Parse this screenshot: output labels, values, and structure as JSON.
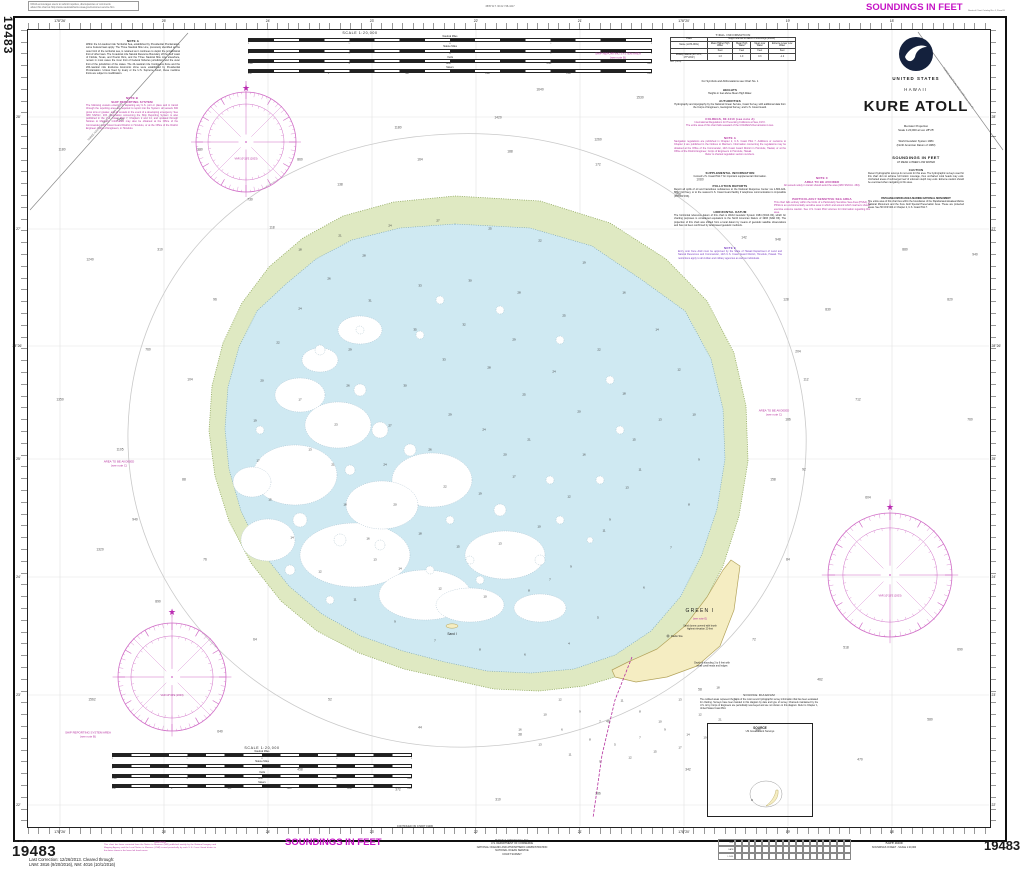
{
  "page": {
    "chart_number": "19483",
    "top_left_note": "NOAA encourages users to submit inquiries, discrepancies or comments\nabout this chart at http://www.nauticalcharts.noaa.gov/customer-service.htm",
    "print_code": "3835 W.T. 30.02  748-4417",
    "soundings_top": "SOUNDINGS IN FEET",
    "catalog_note": "Nautical Chart Catalog No. 4, Panel B",
    "edition": "9th Ed., Jan. 2003",
    "last_correction": "Last Correction: 12/26/2013. Cleared through:\nLNM: 3816 (9/20/2016), NM: 4016 (10/1/2016)",
    "caution_title": "CAUTION",
    "caution_body": "This chart has been corrected from the Notice to Mariners (NM) published weekly by the National Imagery and Mapping Agency and the Local Notice to Mariners (LNM) issued periodically by each U.S. Coast Guard district to the dates shown in the lower left hand corner.",
    "soundings_bottom": "SOUNDINGS IN FEET",
    "continued_note": "CONTINUED ON CHART 19480",
    "publisher": "Published at Washington, D.C.\nU.S. DEPARTMENT OF COMMERCE\nNATIONAL OCEANIC AND ATMOSPHERIC ADMINISTRATION\nNATIONAL OCEAN SERVICE\nCOAST SURVEY",
    "footer_title": "Kure Atoll",
    "footer_subtitle": "SOUNDINGS IN FEET - SCALE 1:20,000",
    "correction_rows": [
      "N.M.",
      "DATE",
      "L.N.M."
    ]
  },
  "title_block": {
    "country": "UNITED STATES",
    "state": "HAWAII",
    "title": "KURE ATOLL",
    "projection": "Mercator Projection\nScale 1:20,000 at Lat. 28°25'",
    "datum": "World Geodetic System 1984\n(North American Datum of 1983)",
    "soundings": "SOUNDINGS IN FEET",
    "soundings_sub": "AT MEAN LOWER LOW WATER",
    "caution": {
      "title": "CAUTION",
      "body": "Recent hydrographic surveys do not exist for this area. The hydrographic surveys used for this chart did not achieve full bottom coverage, thus uncharted coral heads may exist. Uncharted areas of submerged reef of unknown depth may exist. Extreme caution should be exercised when navigating in this area."
    },
    "monument": {
      "title": "PAPAHANAUMOKUAKEA MARINE NATIONAL MONUMENT",
      "body": "The entire area of this chart lies within the boundaries of the Papahanaumokuakea Marine National Monument and the Kure Atoll Special Preservation Area. These are protected areas. See 50 CFR 404 or Chapter 2, U.S. Coast Pilot 7."
    }
  },
  "notes": {
    "note_a": {
      "title": "NOTE A",
      "body": "Within the 12-nautical mile Territorial Sea, established by Presidential Proclamation, some Federal laws apply. The Three Nautical Mile Line, previously identified as the outer limit of the territorial sea, is retained as it continues to depict the jurisdictional limit of other laws. The 9-nautical mile Natural Resource Boundary off the Gulf coast of Florida, Texas, and Puerto Rico, and the Three Nautical Mile Line elsewhere, remain in most cases the inner limit of Federal fisheries jurisdiction and the outer limit of the jurisdiction of the states. The 24-nautical mile Contiguous Zone and the 200-nautical mile Exclusive Economic Zone were established by Presidential Proclamation. Unless fixed by treaty or the U.S. Supreme Court, these maritime limits are subject to modification."
    },
    "note_b": {
      "title": "NOTE B",
      "subtitle": "SHIP REPORTING SYSTEM",
      "body": "The following vessels entering or departing any U.S. port or place and in transit through the reporting area are required to report into the System: all vessels 300 gross tons or greater, and all vessels in the event of a developing emergency. See IMO SN/Circ. 215. Information concerning the Ship Reporting System is also published in the U.S. Coast Pilot 7, Chapters 2 and 14, and updated through Notices to Mariners. Information may also be obtained at the Office of the Commander, 14th Coast Guard District in Honolulu, or at the Office of the District Engineer, Corps of Engineers, in Honolulu."
    },
    "symbols": "For Symbols and Abbreviations see Chart No. 1",
    "heights": {
      "title": "HEIGHTS",
      "body": "Heights in feet above Mean High Water."
    },
    "authorities": {
      "title": "AUTHORITIES",
      "body": "Hydrography and topography by the National Ocean Service, Coast Survey, with additional data from the Corps of Engineers, Geological Survey, and U.S. Coast Guard."
    },
    "colregs": {
      "title": "COLREGS, 80.1410 (see note A)",
      "body": "International Regulations for Preventing Collisions at Sea, 1972.\nThe entire area of this chart falls seaward of the COLREGS Demarcation Lines."
    },
    "nav_regs": {
      "title": "NOTE A",
      "body": "Navigation regulations are published in Chapter 2, U.S. Coast Pilot 7. Additions or revisions to Chapter 2 are published in the Notices to Mariners. Information concerning the regulations may be obtained at the Office of the Commander, 14th Coast Guard District in Honolulu, Hawaii, or at the Office of the District Engineer, Corps of Engineers in Honolulu, Hawaii.",
      "tail": "Refer to charted regulation section numbers."
    },
    "supplemental": {
      "title": "SUPPLEMENTAL INFORMATION",
      "body": "Consult U.S. Coast Pilot 7 for important supplemental information."
    },
    "pollution": {
      "title": "POLLUTION REPORTS",
      "body": "Report all spills of oil and hazardous substances to the National Response Center via 1-800-424-8802 (toll free), or to the nearest U.S. Coast Guard facility if telephone communication is impossible (33 CFR 153)."
    },
    "datum": {
      "title": "HORIZONTAL DATUM",
      "body": "The horizontal reference datum of this chart is World Geodetic System 1984 (WGS 84), which for charting purposes is considered equivalent to the North American Datum of 1983 (NAD 83). The projection of this chart was shifted from a local datum by means of geodetic satellite observations and has not been confirmed by land-based geodetic methods."
    },
    "note_e": {
      "title": "NOTE E",
      "body": "Entry onto Kure Atoll must be approved by the State of Hawaii Department of Land and Natural Resources and Commander, 14th U.S. Coast Guard District, Honolulu, Hawaii. The restrictions apply to all civilian and military agencies as well as individuals."
    },
    "note_c": {
      "title": "NOTE C",
      "subtitle": "AREA TO BE AVOIDED",
      "body": "All vessels solely in transit should avoid the area (IMO SN/Circ. 263)."
    },
    "pssa": {
      "title": "PARTICULARLY SENSITIVE SEA AREA",
      "body": "This chart falls entirely within the limits of a Particularly Sensitive Sea Area (PSSA). A PSSA is an environmentally sensitive area in which and around which mariners should exercise extreme caution. See U.S. Coast Pilot volumes for information regarding this area."
    }
  },
  "tidal": {
    "title": "TIDAL INFORMATION",
    "place_header": "Place",
    "heights_header": "Height referred to datum of soundings (MLLW)",
    "name_label": "Name",
    "latlong_label": "(LAT/LONG)",
    "columns": [
      "Mean Higher High Water",
      "Mean High Water",
      "Mean Low Water",
      "Extreme Lower Low Water"
    ],
    "units": "Feet",
    "station": "Midway Islands (28°13'N., 177°22'W.)",
    "values": [
      "1.3",
      "1.0",
      "0.3",
      "-1.2"
    ],
    "note": "Nov. (2003)"
  },
  "scale": {
    "title": "SCALE 1:20,000",
    "rows": [
      {
        "label": "Nautical Miles",
        "ticks": [
          "1",
          "½",
          "0",
          "½",
          "1"
        ]
      },
      {
        "label": "Statute Miles",
        "ticks": [
          "1",
          "½",
          "0",
          "½",
          "1"
        ]
      },
      {
        "label": "Yards",
        "ticks": [
          "1000",
          "0",
          "1000",
          "2000",
          "3000"
        ]
      },
      {
        "label": "Meters",
        "ticks": [
          "500",
          "0",
          "500",
          "1000",
          "1500",
          "2000"
        ]
      }
    ]
  },
  "source": {
    "title": "SOURCE DIAGRAM",
    "body": "The outlined areas represent the limits of the most recent hydrographic survey information that has been evaluated for charting. Surveys have been banded in this diagram by date and type of survey. Channels maintained by the U.S. Army Corps of Engineers are periodically resurveyed and are not shown on this diagram. Refer to Chapter 1, United States Coast Pilot.",
    "box_title": "SOURCE",
    "box_subtitle": "US Government Surveys"
  },
  "map": {
    "labels": {
      "srs": "SHIP REPORTING SYSTEM AREA\n(see note B)",
      "avoid": "AREA TO BE AVOIDED\n(see note C)",
      "green_island": "GREEN I",
      "green_note": "(see note E)",
      "dunes": "Sand dunes covered with brush\nhighest elevation 20 feet",
      "radio": "Radio Sta",
      "depth_note": "Depth of sounding 3 to 6 feet with\nsmall coral heads and ledges",
      "sand_island": "Sand I",
      "three_nm": "THREE NAUTICAL MILE LINE (see note A)"
    },
    "rose_variation": "VAR 10°15'E (2003)",
    "colors": {
      "magenta": "#b5309f",
      "rose": "#d06cc6",
      "lagoon": "#cfe9f2",
      "reef": "#dfe9c2",
      "island": "#f5edc2"
    }
  },
  "graticule": {
    "lon": [
      {
        "x": 60,
        "label": "178°26'"
      },
      {
        "x": 164,
        "label": "25'"
      },
      {
        "x": 268,
        "label": "24'"
      },
      {
        "x": 372,
        "label": "23'"
      },
      {
        "x": 476,
        "label": "22'"
      },
      {
        "x": 580,
        "label": "21'"
      },
      {
        "x": 684,
        "label": "178°20'"
      },
      {
        "x": 788,
        "label": "19'"
      },
      {
        "x": 892,
        "label": "18'"
      }
    ],
    "lat": [
      {
        "y": 117,
        "label": "28'"
      },
      {
        "y": 229,
        "label": "27'"
      },
      {
        "y": 346,
        "label": "28°26'"
      },
      {
        "y": 459,
        "label": "25'"
      },
      {
        "y": 577,
        "label": "24'"
      },
      {
        "y": 695,
        "label": "23'"
      },
      {
        "y": 805,
        "label": "22'"
      }
    ]
  },
  "soundings": {
    "lagoon": [
      [
        300,
        250,
        18
      ],
      [
        340,
        236,
        21
      ],
      [
        390,
        226,
        24
      ],
      [
        438,
        221,
        27
      ],
      [
        490,
        229,
        25
      ],
      [
        540,
        241,
        22
      ],
      [
        584,
        263,
        19
      ],
      [
        624,
        293,
        16
      ],
      [
        657,
        330,
        14
      ],
      [
        679,
        370,
        12
      ],
      [
        694,
        415,
        10
      ],
      [
        699,
        460,
        9
      ],
      [
        689,
        505,
        8
      ],
      [
        671,
        548,
        7
      ],
      [
        644,
        588,
        6
      ],
      [
        598,
        618,
        5
      ],
      [
        569,
        644,
        4
      ],
      [
        525,
        655,
        6
      ],
      [
        480,
        650,
        8
      ],
      [
        435,
        641,
        7
      ],
      [
        395,
        622,
        9
      ],
      [
        355,
        600,
        11
      ],
      [
        320,
        572,
        12
      ],
      [
        292,
        538,
        14
      ],
      [
        270,
        500,
        15
      ],
      [
        258,
        461,
        17
      ],
      [
        255,
        421,
        19
      ],
      [
        262,
        381,
        20
      ],
      [
        278,
        343,
        22
      ],
      [
        300,
        309,
        24
      ],
      [
        329,
        279,
        26
      ],
      [
        364,
        256,
        28
      ],
      [
        370,
        301,
        31
      ],
      [
        420,
        286,
        33
      ],
      [
        470,
        281,
        30
      ],
      [
        519,
        293,
        28
      ],
      [
        564,
        316,
        25
      ],
      [
        599,
        350,
        22
      ],
      [
        624,
        394,
        18
      ],
      [
        634,
        440,
        15
      ],
      [
        627,
        488,
        13
      ],
      [
        604,
        531,
        11
      ],
      [
        571,
        567,
        9
      ],
      [
        529,
        591,
        8
      ],
      [
        485,
        597,
        10
      ],
      [
        440,
        589,
        12
      ],
      [
        400,
        569,
        14
      ],
      [
        368,
        539,
        16
      ],
      [
        345,
        505,
        18
      ],
      [
        333,
        465,
        21
      ],
      [
        336,
        425,
        23
      ],
      [
        348,
        386,
        26
      ],
      [
        300,
        400,
        17
      ],
      [
        310,
        450,
        13
      ],
      [
        415,
        330,
        35
      ],
      [
        464,
        325,
        32
      ],
      [
        514,
        340,
        29
      ],
      [
        554,
        372,
        24
      ],
      [
        579,
        412,
        20
      ],
      [
        584,
        455,
        16
      ],
      [
        569,
        497,
        12
      ],
      [
        539,
        527,
        10
      ],
      [
        500,
        544,
        13
      ],
      [
        458,
        547,
        15
      ],
      [
        420,
        534,
        18
      ],
      [
        395,
        505,
        20
      ],
      [
        385,
        465,
        24
      ],
      [
        390,
        426,
        27
      ],
      [
        405,
        386,
        30
      ],
      [
        444,
        360,
        33
      ],
      [
        489,
        368,
        28
      ],
      [
        524,
        395,
        25
      ],
      [
        529,
        440,
        21
      ],
      [
        514,
        477,
        17
      ],
      [
        480,
        494,
        19
      ],
      [
        445,
        487,
        22
      ],
      [
        430,
        450,
        26
      ],
      [
        450,
        415,
        29
      ],
      [
        484,
        430,
        24
      ],
      [
        505,
        455,
        20
      ],
      [
        350,
        350,
        29
      ],
      [
        375,
        560,
        13
      ],
      [
        550,
        580,
        7
      ],
      [
        610,
        520,
        9
      ],
      [
        640,
        470,
        11
      ],
      [
        660,
        420,
        13
      ]
    ],
    "ocean": [
      [
        120,
        120,
        1450
      ],
      [
        200,
        150,
        980
      ],
      [
        90,
        260,
        1240
      ],
      [
        148,
        350,
        760
      ],
      [
        120,
        450,
        1105
      ],
      [
        100,
        550,
        1320
      ],
      [
        158,
        602,
        890
      ],
      [
        92,
        700,
        1562
      ],
      [
        220,
        732,
        640
      ],
      [
        300,
        770,
        458
      ],
      [
        398,
        790,
        372
      ],
      [
        498,
        800,
        310
      ],
      [
        598,
        794,
        286
      ],
      [
        688,
        770,
        342
      ],
      [
        758,
        731,
        390
      ],
      [
        820,
        680,
        462
      ],
      [
        846,
        648,
        518
      ],
      [
        868,
        498,
        604
      ],
      [
        858,
        400,
        712
      ],
      [
        828,
        310,
        830
      ],
      [
        778,
        240,
        948
      ],
      [
        700,
        180,
        1080
      ],
      [
        598,
        140,
        1260
      ],
      [
        498,
        118,
        1420
      ],
      [
        398,
        128,
        1180
      ],
      [
        300,
        160,
        860
      ],
      [
        250,
        200,
        730
      ],
      [
        788,
        420,
        186
      ],
      [
        798,
        352,
        204
      ],
      [
        773,
        480,
        158
      ],
      [
        540,
        90,
        1640
      ],
      [
        640,
        98,
        1530
      ],
      [
        215,
        300,
        96
      ],
      [
        190,
        380,
        104
      ],
      [
        184,
        480,
        88
      ],
      [
        205,
        560,
        76
      ],
      [
        255,
        640,
        64
      ],
      [
        330,
        700,
        52
      ],
      [
        420,
        728,
        44
      ],
      [
        520,
        735,
        38
      ],
      [
        608,
        722,
        46
      ],
      [
        700,
        690,
        58
      ],
      [
        754,
        640,
        72
      ],
      [
        788,
        560,
        84
      ],
      [
        804,
        470,
        92
      ],
      [
        806,
        380,
        112
      ],
      [
        786,
        300,
        128
      ],
      [
        744,
        238,
        142
      ],
      [
        678,
        195,
        158
      ],
      [
        598,
        165,
        172
      ],
      [
        510,
        152,
        188
      ],
      [
        420,
        160,
        164
      ],
      [
        340,
        185,
        138
      ],
      [
        272,
        228,
        118
      ],
      [
        160,
        250,
        310
      ],
      [
        135,
        520,
        940
      ],
      [
        60,
        400,
        1350
      ],
      [
        62,
        150,
        1180
      ],
      [
        950,
        300,
        820
      ],
      [
        970,
        420,
        760
      ],
      [
        960,
        650,
        690
      ],
      [
        930,
        720,
        580
      ],
      [
        860,
        760,
        470
      ],
      [
        975,
        255,
        940
      ],
      [
        905,
        250,
        880
      ]
    ],
    "bank": [
      [
        560,
        700,
        12
      ],
      [
        580,
        712,
        9
      ],
      [
        600,
        722,
        7
      ],
      [
        622,
        701,
        11
      ],
      [
        640,
        712,
        8
      ],
      [
        660,
        722,
        10
      ],
      [
        680,
        700,
        13
      ],
      [
        562,
        730,
        6
      ],
      [
        590,
        740,
        8
      ],
      [
        615,
        745,
        5
      ],
      [
        640,
        738,
        7
      ],
      [
        665,
        730,
        9
      ],
      [
        545,
        715,
        10
      ],
      [
        700,
        715,
        12
      ],
      [
        688,
        735,
        14
      ],
      [
        570,
        755,
        11
      ],
      [
        600,
        762,
        9
      ],
      [
        630,
        758,
        12
      ],
      [
        655,
        752,
        15
      ],
      [
        680,
        748,
        17
      ],
      [
        705,
        738,
        19
      ],
      [
        540,
        745,
        13
      ],
      [
        520,
        730,
        16
      ],
      [
        720,
        720,
        21
      ],
      [
        735,
        700,
        24
      ],
      [
        718,
        688,
        18
      ]
    ]
  }
}
